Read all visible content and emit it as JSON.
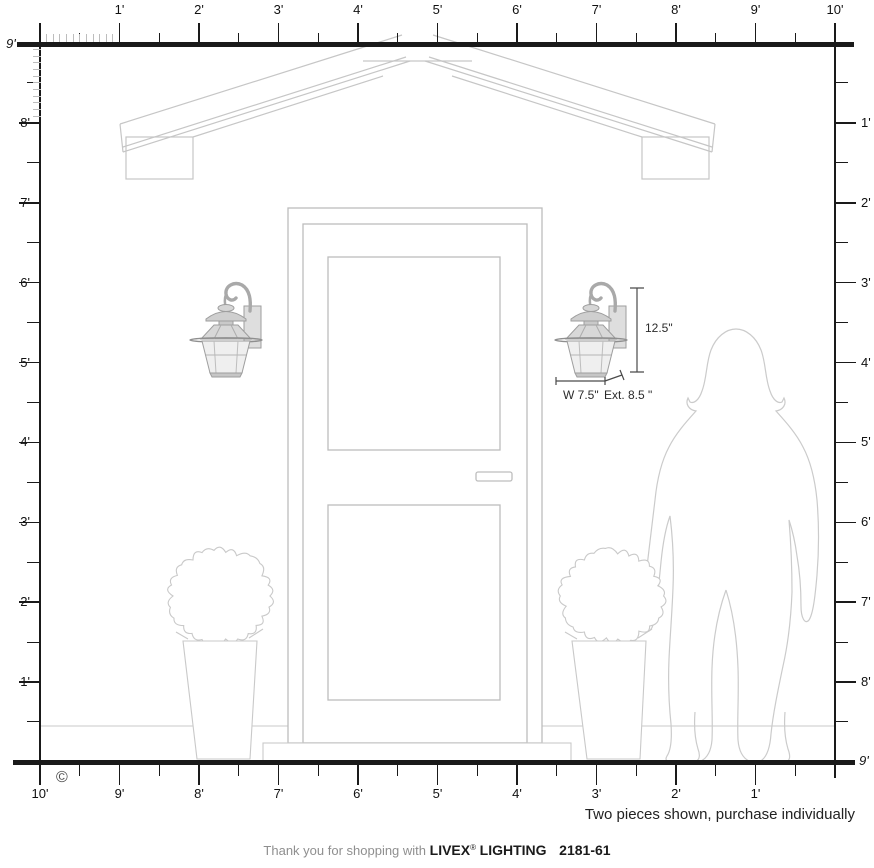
{
  "rulers": {
    "top": {
      "unit_labels": [
        "1'",
        "2'",
        "3'",
        "4'",
        "5'",
        "6'",
        "7'",
        "8'",
        "9'",
        "10'"
      ]
    },
    "left": {
      "unit_labels": [
        "9'",
        "8'",
        "7'",
        "6'",
        "5'",
        "4'",
        "3'",
        "2'",
        "1'"
      ]
    },
    "right": {
      "unit_labels": [
        "1'",
        "2'",
        "3'",
        "4'",
        "5'",
        "6'",
        "7'",
        "8'"
      ],
      "corner_label": "9'"
    },
    "bottom": {
      "unit_labels": [
        "10'",
        "9'",
        "8'",
        "7'",
        "6'",
        "5'",
        "4'",
        "3'",
        "2'",
        "1'"
      ]
    }
  },
  "dimensions": {
    "height": "12.5\"",
    "width": "W 7.5\"",
    "extension": "Ext. 8.5 \""
  },
  "note": "Two pieces shown, purchase individually",
  "copyright": "©",
  "footer": {
    "prefix": "Thank you for shopping with",
    "brand": "LIVEX",
    "registered": "®",
    "brand_suffix": "LIGHTING",
    "model": "2181-61"
  },
  "colors": {
    "ruler": "#1a1a1a",
    "sketch_line": "#c6c6c6",
    "lantern_frame": "#9e9e9e"
  }
}
